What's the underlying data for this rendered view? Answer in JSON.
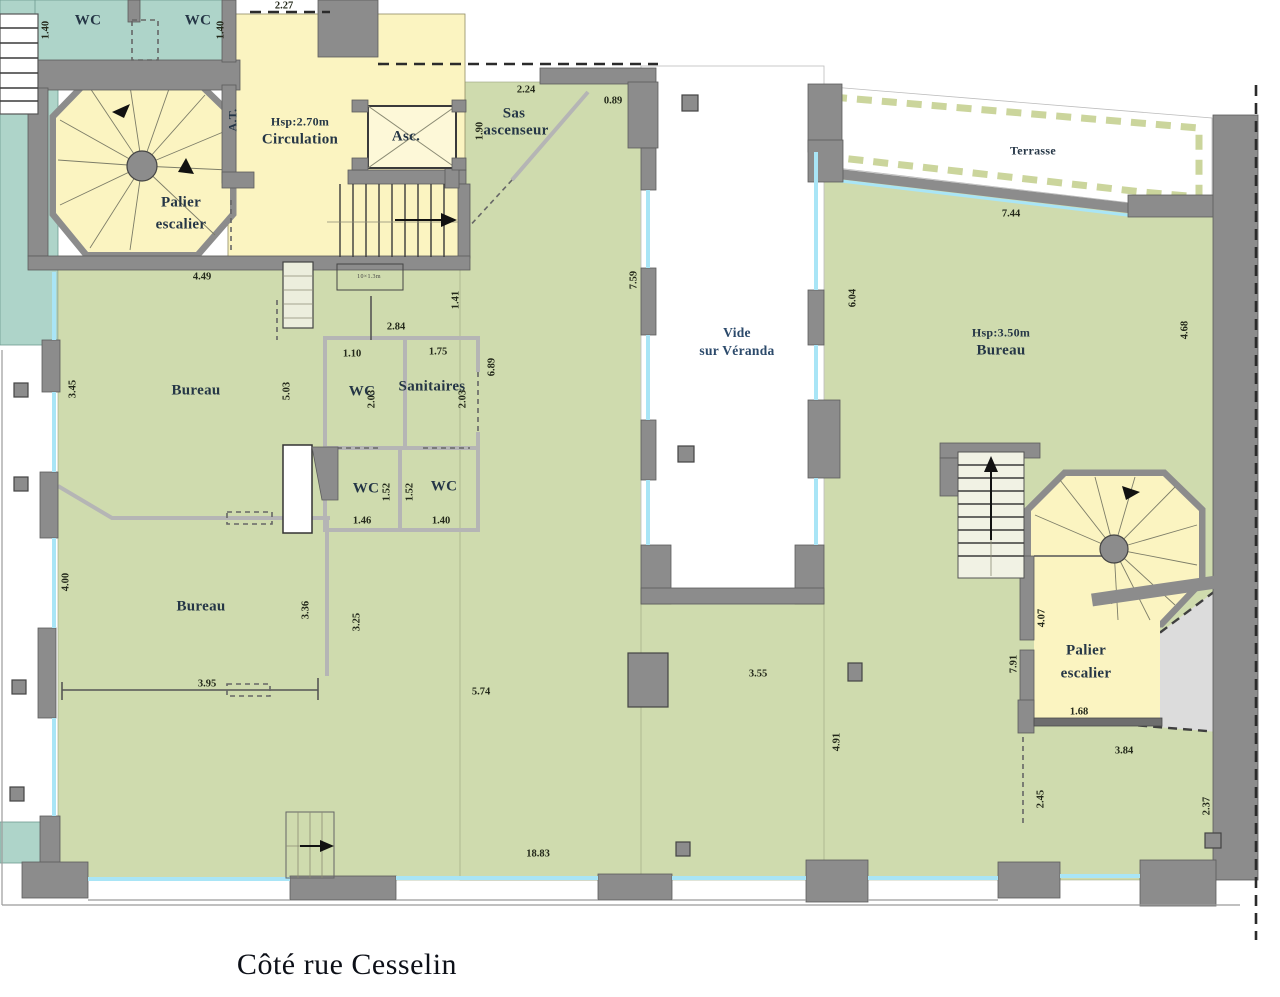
{
  "plan": {
    "title": "Côté rue Cesselin",
    "colors": {
      "green": "#cfdbae",
      "yellow": "#fbf4c1",
      "teal": "#aed4c9",
      "wall": "#8c8c8c",
      "wall2": "#b5b5b5",
      "glass": "#a9e5f6",
      "hatch": "#dcdcdc",
      "terr": "#cbd59c",
      "ink": "#253646",
      "dim": "#23281a",
      "blue": "#2c4a6b"
    },
    "rooms": {
      "wc_left": "WC",
      "wc_right": "WC",
      "palier_left_1": "Palier",
      "palier_left_2": "escalier",
      "circulation_height": "Hsp:2.70m",
      "circulation": "Circulation",
      "elevator": "Asc.",
      "at": "A.T.",
      "sas_1": "Sas",
      "sas_2": "ascenseur",
      "bureau_upper": "Bureau",
      "bureau_lower": "Bureau",
      "wc_mid": "WC",
      "sanitaires": "Sanitaires",
      "wc_low_left": "WC",
      "wc_low_right": "WC",
      "vide_1": "Vide",
      "vide_2": "sur Véranda",
      "terrasse": "Terrasse",
      "bureau_right_height": "Hsp:3.50m",
      "bureau_right": "Bureau",
      "palier_right_1": "Palier",
      "palier_right_2": "escalier",
      "stair_note": "10×1.3m"
    },
    "dimensions": {
      "top_width": "2.27",
      "wc_left_h": "1.40",
      "wc_right_h": "1.40",
      "sas_w": "2.24",
      "sas_right": "0.89",
      "sas_h": "1.90",
      "bureau1_top": "4.49",
      "bureau1_left": "3.45",
      "bureau1_right": "5.03",
      "san_top": "2.84",
      "wc_mid_w": "1.10",
      "san_w": "1.75",
      "wc_mid_h": "2.03",
      "san_h": "2.03",
      "san_corner": "1.41",
      "san_right": "6.89",
      "wc_low_l_h": "1.52",
      "wc_low_r_h": "1.52",
      "wc_low_l_w": "1.46",
      "wc_low_r_w": "1.40",
      "vide_left": "7.59",
      "vide_right": "6.04",
      "terr_w": "7.44",
      "bureau_r_right": "4.68",
      "bureau2_left": "4.00",
      "bureau2_right": "3.36",
      "open_left": "3.25",
      "bureau2_bottom": "3.95",
      "open_w": "5.74",
      "open_mid": "3.55",
      "open_mid_v": "4.91",
      "total_w": "18.83",
      "palier_r_left": "4.07",
      "palier_r_outer": "7.91",
      "palier_r_bottom": "1.68",
      "below_palier": "3.84",
      "below_palier_v": "2.45",
      "right_edge": "2.37"
    }
  }
}
